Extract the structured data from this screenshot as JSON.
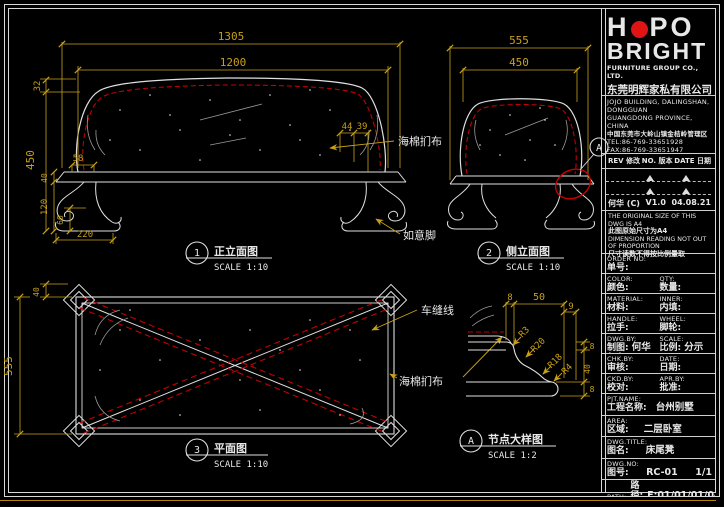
{
  "colors": {
    "background": "#000000",
    "line": "#e0e0e0",
    "dimension": "#c8a018",
    "red": "#c40000",
    "gray": "#9a9a9a",
    "logo_red": "#e01414"
  },
  "views": {
    "front": {
      "bubble": "1",
      "title": "正立面图",
      "scale": "SCALE 1:10"
    },
    "side": {
      "bubble": "2",
      "title": "侧立面图",
      "scale": "SCALE 1:10"
    },
    "plan": {
      "bubble": "3",
      "title": "平面图",
      "scale": "SCALE 1:10"
    },
    "detail": {
      "bubble": "A",
      "title": "节点大样图",
      "scale": "SCALE 1:2"
    }
  },
  "callout": {
    "a": "A"
  },
  "front_labels": {
    "upholstery": "海棉扪布",
    "leg": "如意脚"
  },
  "plan_labels": {
    "seam": "车缝线",
    "upholstery": "海棉扪布"
  },
  "dims": {
    "front": {
      "w1305": "1305",
      "w1200": "1200",
      "h32": "32",
      "h450": "450",
      "h40": "40",
      "h120": "120",
      "h60": "60",
      "w220": "220",
      "w58": "58",
      "w44": "44",
      "w39": "39"
    },
    "side": {
      "w555": "555",
      "w450": "450"
    },
    "plan": {
      "h40": "40",
      "h555": "555"
    },
    "detail": {
      "t8": "8",
      "t50": "50",
      "t9": "9",
      "r3": "R3",
      "r20": "R20",
      "r18": "R18",
      "r4": "R4",
      "s8a": "8",
      "s40": "40",
      "s8b": "8"
    }
  },
  "titleblock": {
    "logo": {
      "h": "H",
      "po": "PO",
      "line2": "BRIGHT",
      "sub_en": "FURNITURE GROUP CO., LTD.",
      "sub_cn": "东莞明辉家私有限公司"
    },
    "contact": {
      "addr_en1": "JOJO BUILDING, DALINGSHAN, DONGGUAN",
      "addr_en2": "GUANGDONG PROVINCE, CHINA",
      "addr_cn": "中国东莞市大岭山镇金桔岭管理区",
      "tel": "TEL:86-769-33651928",
      "fax": "FAX:86-769-33651947",
      "email": "E-MAIL:brightlight@gch.dgunl.gd.cn",
      "web": "http://www.hopo-bright.com"
    },
    "revision": {
      "col1": "REV 修改",
      "col2": "NO. 版本",
      "col3": "DATE 日期",
      "row": {
        "by": "何华 (C)",
        "ver": "V1.0",
        "date": "04.08.21"
      }
    },
    "notes": {
      "en1": "THE ORIGINAL SIZE OF THIS DWG IS A4",
      "cn1": "此图原始尺寸为A4",
      "en2": "DIMENSION READING NOT OUT",
      "en3": "OF PROPORTION",
      "cn2": "尺寸读数不得按比例量取"
    },
    "fields": [
      {
        "en": "ORDER NO:",
        "cn": "单号:",
        "value": "",
        "en2": "",
        "cn2": "",
        "value2": ""
      },
      {
        "en": "COLOR:",
        "cn": "颜色:",
        "value": "",
        "en2": "QTY:",
        "cn2": "数量:",
        "value2": ""
      },
      {
        "en": "MATERIAL:",
        "cn": "材料:",
        "value": "",
        "en2": "INNER:",
        "cn2": "内填:",
        "value2": ""
      },
      {
        "en": "HANDLE:",
        "cn": "拉手:",
        "value": "",
        "en2": "WHEEL:",
        "cn2": "脚轮:",
        "value2": ""
      },
      {
        "en": "DWG.BY:",
        "cn": "制图:",
        "value": "何华 (C)",
        "en2": "SCALE:",
        "cn2": "比例:",
        "value2": "分示"
      },
      {
        "en": "CHK.BY:",
        "cn": "审核:",
        "value": "",
        "en2": "DATE:",
        "cn2": "日期:",
        "value2": ""
      },
      {
        "en": "CKD.BY:",
        "cn": "校对:",
        "value": "",
        "en2": "APR.BY:",
        "cn2": "批准:",
        "value2": ""
      }
    ],
    "project": [
      {
        "en": "PJT.NAME:",
        "cn": "工程名称:",
        "value": "台州别墅"
      },
      {
        "en": "AREA:",
        "cn": "区域:",
        "value": "二层卧室"
      },
      {
        "en": "DWG.TITLE:",
        "cn": "图名:",
        "value": "床尾凳"
      },
      {
        "en": "DWG.NO:",
        "cn": "图号:",
        "value": "RC-01",
        "extra": "1/1"
      },
      {
        "en": "PATH:",
        "cn": "路径:",
        "value": "E:01/01/01/0448"
      }
    ]
  }
}
